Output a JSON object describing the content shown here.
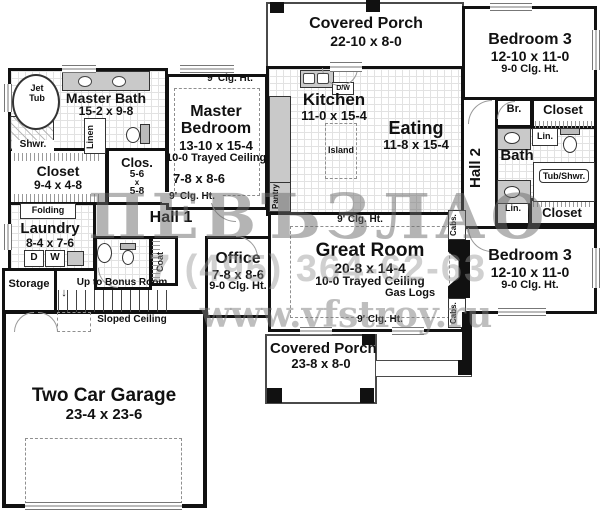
{
  "colors": {
    "wall": "#111111",
    "floor": "#ffffff",
    "tile_line": "#e2e2e2",
    "counter_fill": "#c9c9c9",
    "watermark_gray": "#8a8a8a"
  },
  "watermark": {
    "text": "ПЕВЪЗЛАО",
    "phone": "7 (495) 364-62-63",
    "site": "www.vfstroy.ru"
  },
  "labels": {
    "clg9": "9' Clg. Ht.",
    "cabs": "Cabs.",
    "lin": "Lin.",
    "linen": "Linen",
    "closet": "Closet",
    "coat": "Coat",
    "pantry": "Pantry",
    "island": "Island",
    "folding": "Folding",
    "shwr": "Shwr.",
    "jet": "Jet",
    "tub": "Tub",
    "tub_shwr": "Tub/Shwr.",
    "gas_logs": "Gas Logs",
    "dw": "D/W",
    "d": "D",
    "w": "W",
    "up_bonus": "Up to Bonus Room",
    "sloped": "Sloped Ceiling",
    "hall1": "Hall 1",
    "hall2": "Hall 2",
    "bath": "Bath",
    "br": "Br.",
    "storage": "Storage"
  },
  "rooms": {
    "top_porch": {
      "name": "Covered Porch",
      "dims": "22-10 x 8-0"
    },
    "bedroom3_top": {
      "name": "Bedroom 3",
      "dims": "12-10 x 11-0",
      "clg": "9-0 Clg. Ht."
    },
    "bedroom3_bottom": {
      "name": "Bedroom 3",
      "dims": "12-10 x 11-0",
      "clg": "9-0 Clg. Ht."
    },
    "master_bath": {
      "name": "Master Bath",
      "dims": "15-2 x 9-8"
    },
    "master_bedroom": {
      "name1": "Master",
      "name2": "Bedroom",
      "dims": "13-10 x 15-4",
      "ceiling": "10-0 Trayed Ceiling",
      "sitting": "7-8 x 8-6"
    },
    "closet_master": {
      "name": "Closet",
      "dims": "9-4 x 4-8"
    },
    "clos_small": {
      "name": "Clos.",
      "w": "5-6",
      "x": "x",
      "h": "5-8"
    },
    "laundry": {
      "name": "Laundry",
      "dims": "8-4 x 7-6"
    },
    "kitchen": {
      "name": "Kitchen",
      "dims": "11-0 x 15-4"
    },
    "eating": {
      "name": "Eating",
      "dims": "11-8 x 15-4"
    },
    "great_room": {
      "name": "Great Room",
      "dims": "20-8 x 14-4",
      "ceiling": "10-0 Trayed Ceiling"
    },
    "office": {
      "name": "Office",
      "dims": "7-8 x 8-6",
      "clg": "9-0 Clg. Ht."
    },
    "garage": {
      "name": "Two Car Garage",
      "dims": "23-4 x 23-6"
    },
    "bottom_porch": {
      "name": "Covered Porch",
      "dims": "23-8 x 8-0"
    }
  }
}
